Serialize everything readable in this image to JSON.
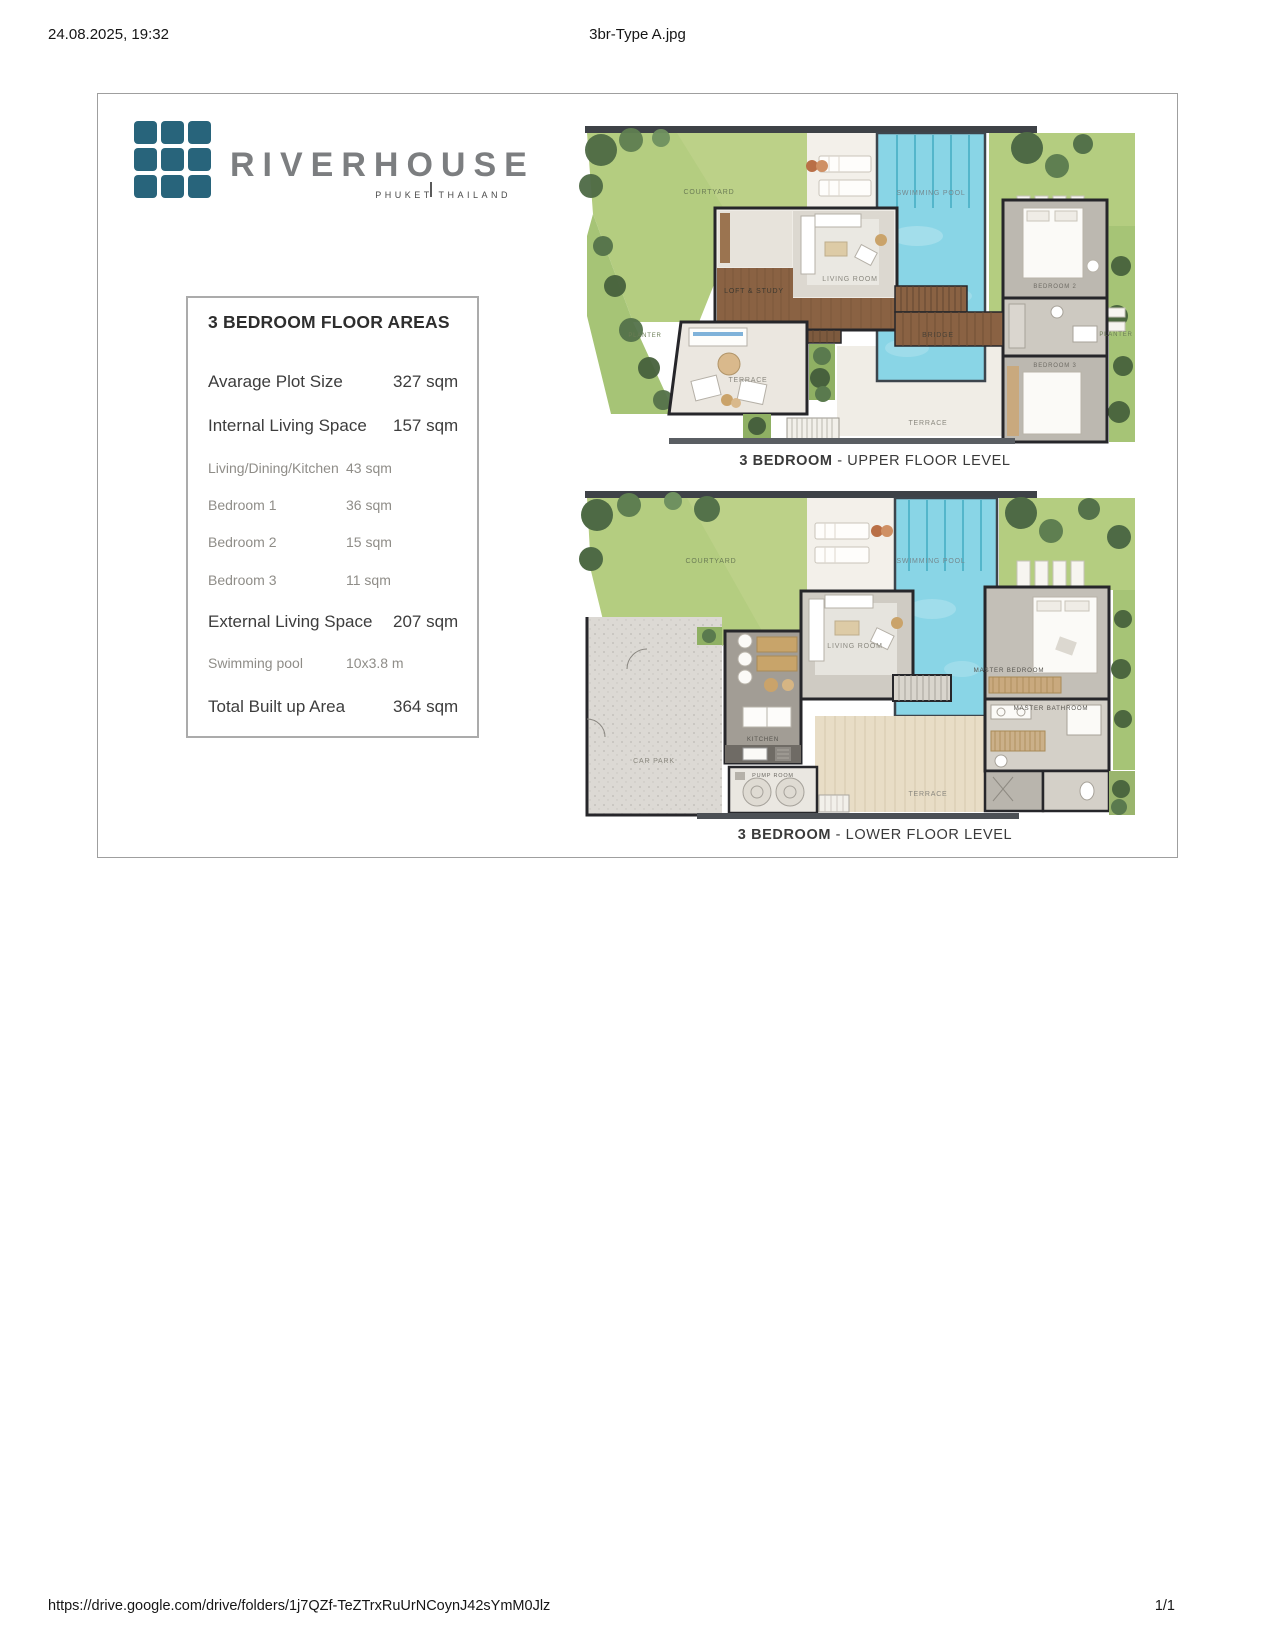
{
  "header": {
    "datetime": "24.08.2025, 19:32",
    "filename": "3br-Type A.jpg"
  },
  "footer": {
    "url": "https://drive.google.com/drive/folders/1j7QZf-TeZTrxRuUrNCoynJ42sYmM0Jlz",
    "page_indicator": "1/1"
  },
  "brand": {
    "name": "RIVERHOUSE",
    "tagline": "PHUKET THAILAND"
  },
  "colors": {
    "brand_teal": "#28647b",
    "lawn_green": "#b4cd80",
    "pool_blue": "#89d5e6",
    "wood_brown": "#8a6243"
  },
  "areas_table": {
    "title": "3 BEDROOM FLOOR AREAS",
    "rows": [
      {
        "label": "Avarage Plot Size",
        "value": "327 sqm"
      },
      {
        "label": "Internal Living Space",
        "value": "157 sqm"
      },
      {
        "label": "Living/Dining/Kitchen",
        "value": "43 sqm"
      },
      {
        "label": "Bedroom 1",
        "value": "36 sqm"
      },
      {
        "label": "Bedroom 2",
        "value": "15 sqm"
      },
      {
        "label": "Bedroom 3",
        "value": "11 sqm"
      },
      {
        "label": "External Living Space",
        "value": "207 sqm"
      },
      {
        "label": "Swimming pool",
        "value": "10x3.8 m"
      },
      {
        "label": "Total Built up Area",
        "value": "364 sqm"
      }
    ]
  },
  "upper_plan": {
    "caption": {
      "bold": "3 BEDROOM",
      "rest": " - UPPER FLOOR LEVEL"
    },
    "labels": {
      "courtyard": "COURTYARD",
      "swimming_pool": "SWIMMING POOL",
      "planter_left": "PLANTER",
      "planter_right": "PLANTER",
      "loft_study": "LOFT & STUDY",
      "living_room": "LIVING ROOM",
      "bridge": "BRIDGE",
      "bedroom_2": "BEDROOM 2",
      "bedroom_3": "BEDROOM 3",
      "terrace_left": "TERRACE",
      "terrace_bottom": "TERRACE"
    }
  },
  "lower_plan": {
    "caption": {
      "bold": "3 BEDROOM",
      "rest": " - LOWER FLOOR LEVEL"
    },
    "labels": {
      "courtyard": "COURTYARD",
      "swimming_pool": "SWIMMING POOL",
      "living_room": "LIVING ROOM",
      "kitchen": "KITCHEN",
      "car_park": "CAR PARK",
      "pump_room": "PUMP ROOM",
      "terrace": "TERRACE",
      "master_bedroom": "MASTER BEDROOM",
      "master_bathroom": "MASTER BATHROOM"
    }
  }
}
